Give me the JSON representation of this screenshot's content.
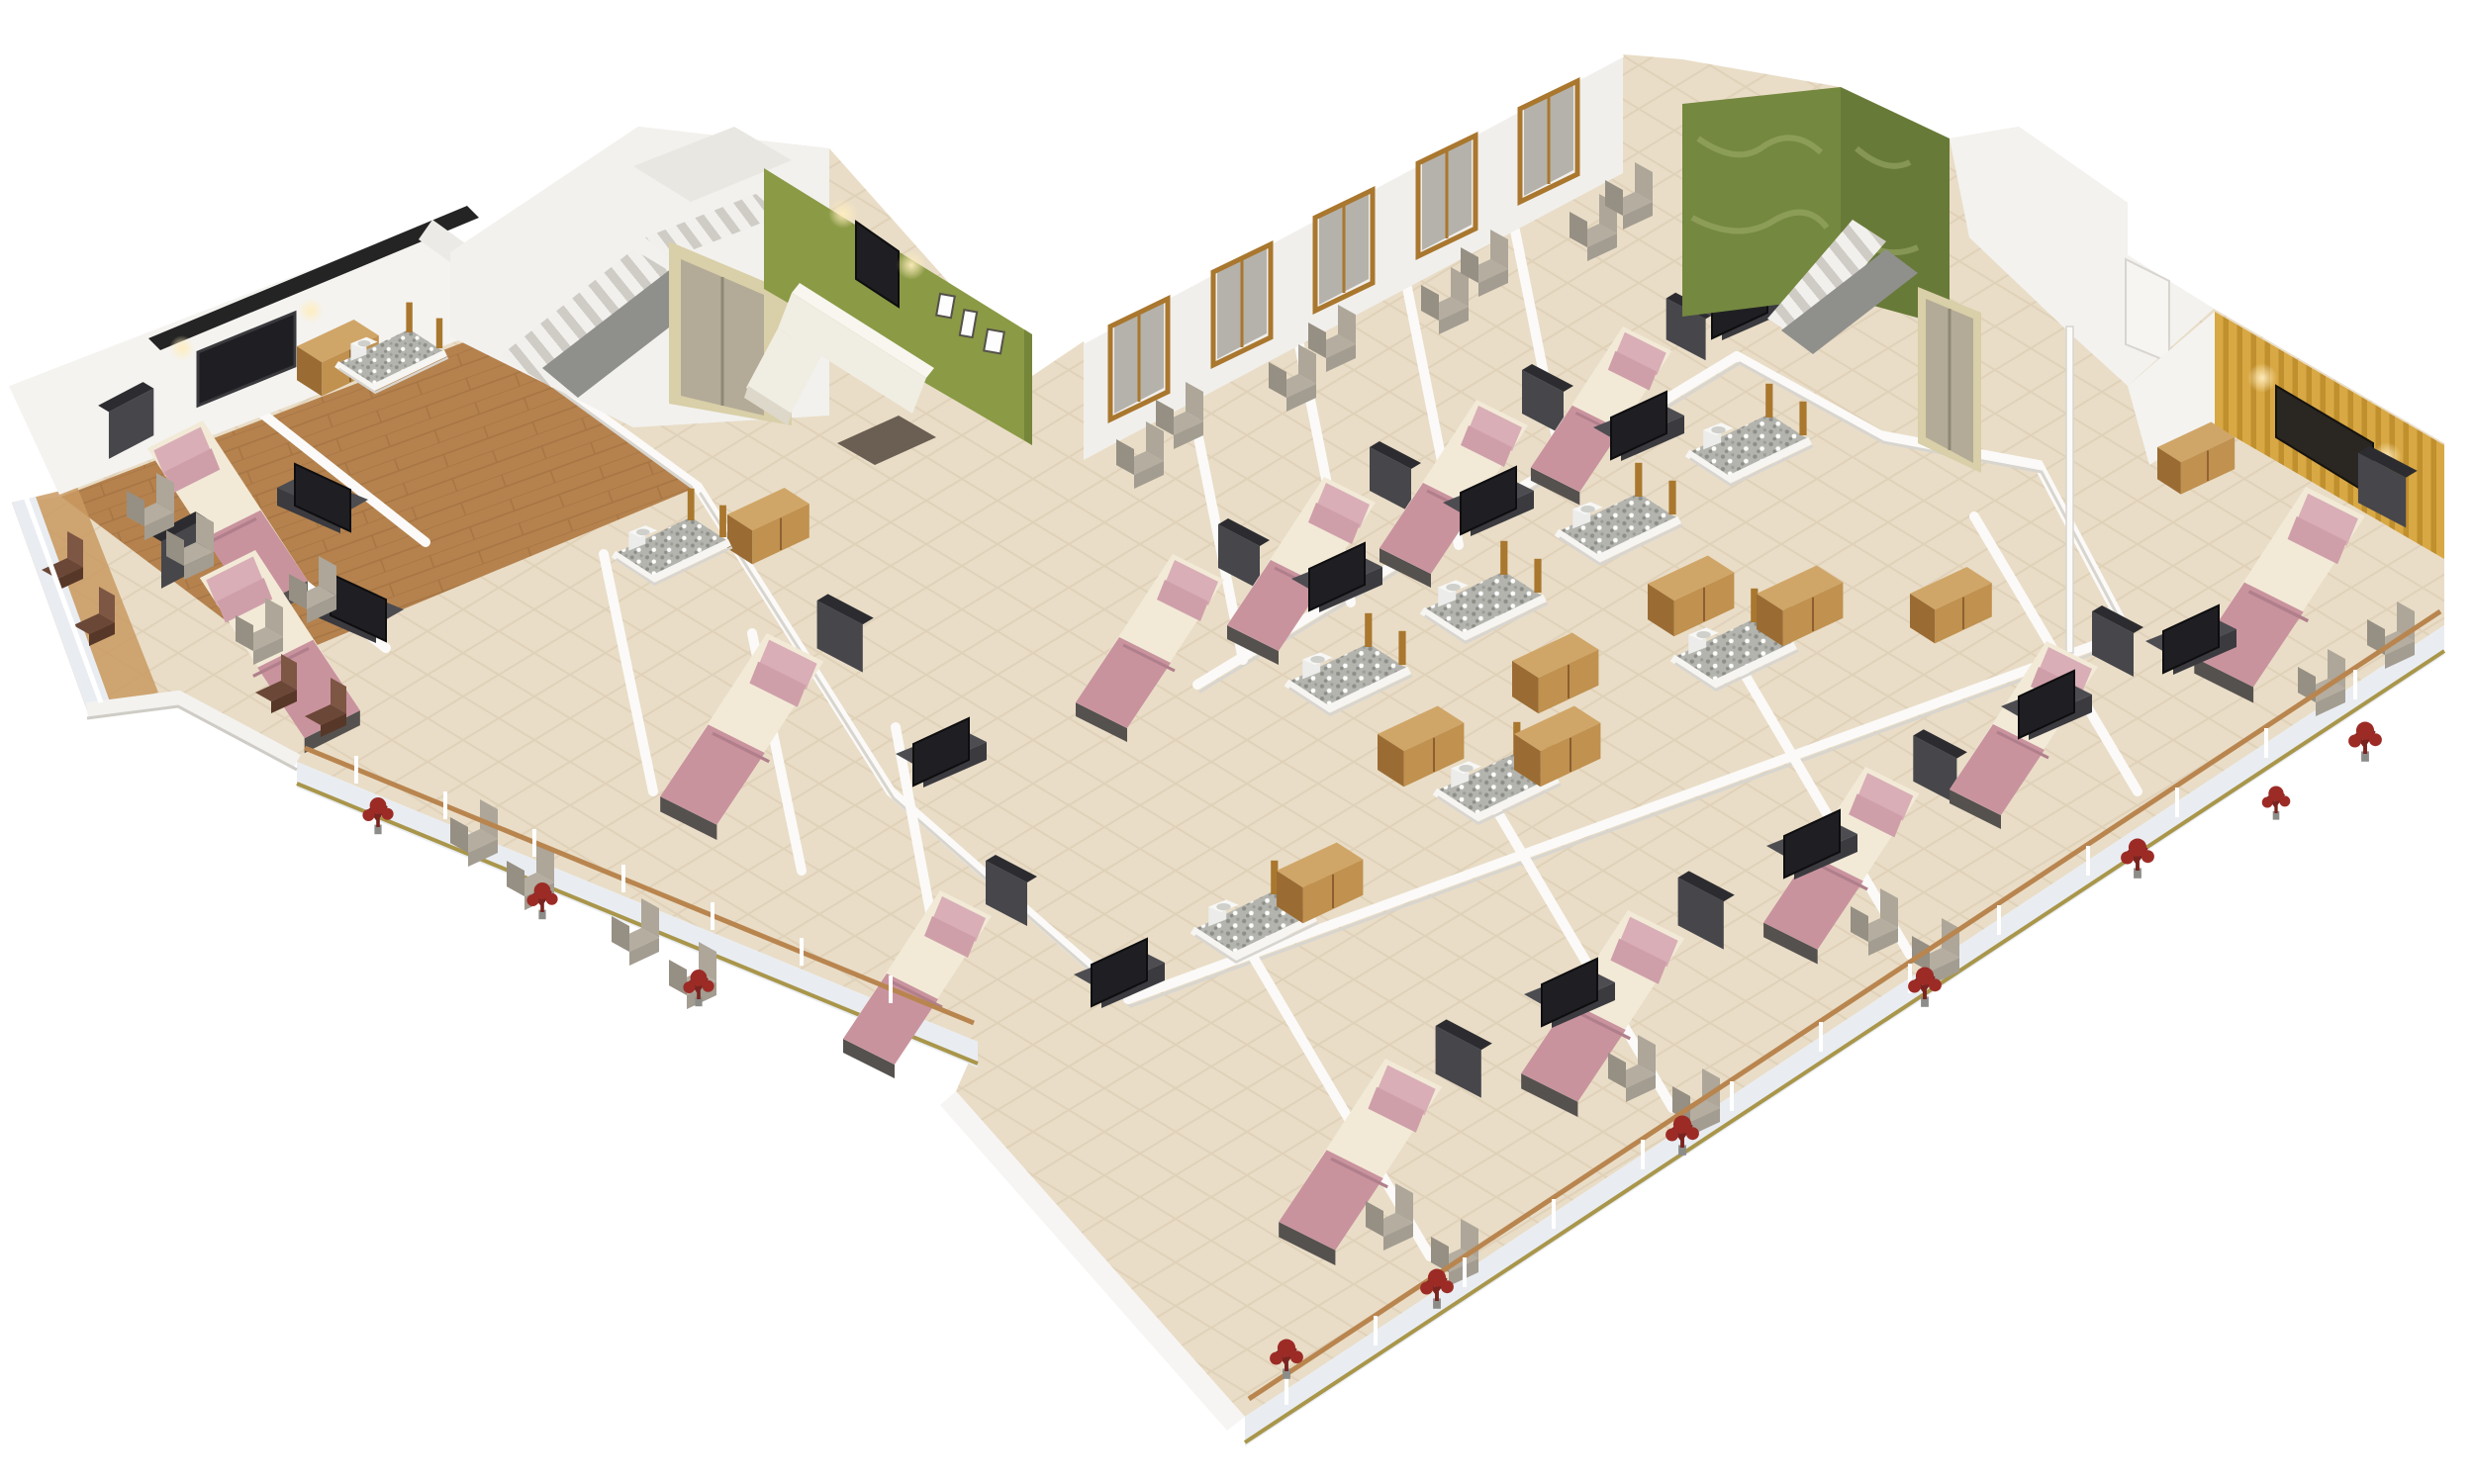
{
  "meta": {
    "title": "3D isometric floor-plan rendering of a hotel floor with furnished guest rooms, two stair lobbies with elevators, a lounge with a green accent wall, a corner suite with a yellow striped accent wall, and balconies decorated with red plants",
    "render_type": "architectural 3D cutaway floor plan",
    "background": "#ffffff"
  },
  "palette": {
    "background": "#ffffff",
    "tile_floor": "#e9ddc7",
    "tile_grid": "#c7b394",
    "wood_floor": "#b5824e",
    "wood_joint": "#8a5c2e",
    "balcony_wood": "#c99a62",
    "wall_white": "#f4f3f0",
    "wall_shadow": "#d9d6d1",
    "wall_dark_band": "#242424",
    "accent_green": "#8a9a45",
    "accent_green_dark": "#75853a",
    "marble_green": "#74883f",
    "marble_green_light": "#a3b272",
    "accent_yellow": "#d8a844",
    "accent_yellow_stripe": "#c08f2e",
    "mattress": "#f2ead7",
    "blanket_pink": "#c9939e",
    "pillow_pink": "#d9aeb6",
    "bed_frame": "#46464b",
    "bed_frame_top": "#2c2c30",
    "tv_screen": "#1f1f23",
    "tv_console": "#4c4c51",
    "tv_console_front": "#3a3a3f",
    "chair_gray": "#b4ada0",
    "chair_gray_dark": "#a39c90",
    "chair_brown": "#6b4737",
    "chair_brown_dark": "#573728",
    "sofa_white": "#f0ede3",
    "sofa_highlight": "#f8f6ef",
    "stair_light": "#f1f0ed",
    "stair_shadow": "#cfccc6",
    "stair_parapet": "#8f8f8c",
    "elevator_steel": "#b3ab97",
    "elevator_frame": "#d9cfa8",
    "rail_wood": "#b9854f",
    "fascia": "#e9edf2",
    "fascia_line": "#a9964a",
    "plant_red": "#9c2b26",
    "pebble_floor": "#b4b4af",
    "pebble_dot": "#8e8e89",
    "wardrobe_wood": "#c0914f",
    "wardrobe_wood_light": "#d0a668",
    "window_frame": "#a9772e",
    "window_glass": "#b5b2ab",
    "art_dark": "#2a2622",
    "sconce_glow": "#ffedbe"
  },
  "legend": {
    "bed": "Double bed: dark headboard panel, white mattress, pink pillows and pink foot blanket",
    "canopy_bed": "Bed with tall dark canopy frame",
    "armchair_gray": "Upholstered armchair, greige fabric",
    "armchair_brown": "Dark brown wooden balcony chair",
    "tv_unit": "Flat-screen TV with dark media console",
    "sofa": "White L-shaped lounge sofa with dark coffee table",
    "bathroom_pod": "En-suite bathroom with gray pebble-mosaic floor, sink and timber door frame",
    "wardrobe": "Timber wardrobe / dresser volume",
    "staircase": "Dog-leg staircase with gray parapet",
    "elevator": "Elevator with brushed-steel doors",
    "red_plant": "Decorative red plant on balcony",
    "railing": "White balcony railing with timber top rail"
  },
  "zones": [
    {
      "id": "left-suite",
      "name": "West corner suite",
      "features": [
        "wooden flooring",
        "long white back wall with wall-mounted TV and two sconces",
        "dark parapet band above wall",
        "mirror on side wall",
        "two double beds",
        "two TV consoles",
        "four gray armchairs",
        "bathroom pod",
        "wardrobe",
        "wrap balcony with four dark brown chairs"
      ]
    },
    {
      "id": "west-stair-lobby",
      "name": "West stair lobby",
      "features": [
        "L-shaped staircase",
        "gray stair parapet",
        "elevator with steel doors"
      ]
    },
    {
      "id": "lounge",
      "name": "Lobby lounge",
      "features": [
        "olive-green accent wall",
        "wall-mounted TV with two lit sconces",
        "three framed pictures",
        "white L-shaped sofa",
        "dark coffee table",
        "beige tiled floor"
      ]
    },
    {
      "id": "north-wing",
      "name": "North guest-room wing",
      "features": [
        "full-height timber-framed windows along rear wall",
        "four guest rooms with canopy-headboard beds",
        "TV consoles",
        "paired armchairs by the windows",
        "bathroom pods with pebble floors",
        "timber wardrobes"
      ]
    },
    {
      "id": "east-stair-lobby",
      "name": "East stair lobby",
      "features": [
        "green-marble feature walls",
        "staircase with gray parapet",
        "elevator with steel door",
        "white service mast"
      ]
    },
    {
      "id": "east-corner-suite",
      "name": "East corner suite",
      "features": [
        "yellow striped accent wall",
        "dark wall art between two lit sconces",
        "double bed",
        "TV console",
        "two armchairs",
        "corner balcony with red plants"
      ]
    },
    {
      "id": "central-corridor",
      "name": "Central corridor network",
      "features": [
        "beige marble tile",
        "bathroom pods either side",
        "timber wardrobes",
        "sinks"
      ]
    },
    {
      "id": "southwest-wing",
      "name": "South-west room wing",
      "features": [
        "canopy bed room",
        "second bedroom with TV",
        "balcony edge with armchairs and red plants",
        "timber-railed parapet"
      ]
    },
    {
      "id": "south-wing",
      "name": "South guest-room wing",
      "features": [
        "four rooms with beds and TV consoles",
        "private balconies with white railings, timber top rails and red plants",
        "service pods along corridor"
      ]
    }
  ],
  "counts": {
    "guest_beds": 13,
    "armchairs_gray": 20,
    "armchairs_brown": 4,
    "tv_units": 12,
    "wall_tvs": 2,
    "bathroom_pods": 10,
    "wardrobes": 9,
    "staircases": 2,
    "elevators": 2,
    "sofas": 1,
    "red_plants": 10,
    "picture_frames": 3,
    "windows_north_wing": 5
  }
}
